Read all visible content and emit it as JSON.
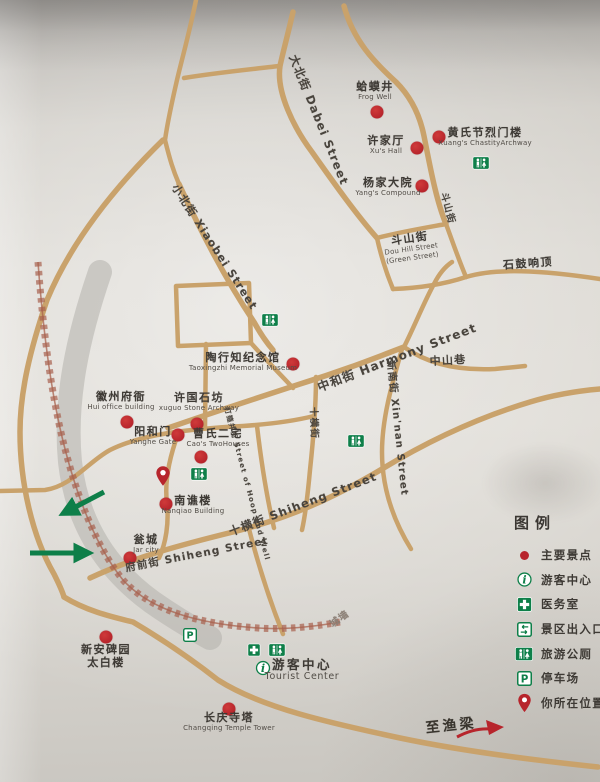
{
  "colors": {
    "road": "#c9a26b",
    "marker": "#b7252c",
    "green": "#0e7f49",
    "wall": "#a8614e"
  },
  "legend": {
    "title": "图例",
    "items": [
      {
        "icon": "dot",
        "label": "主要景点"
      },
      {
        "icon": "info",
        "label": "游客中心"
      },
      {
        "icon": "cross",
        "label": "医务室"
      },
      {
        "icon": "gate",
        "label": "景区出入口"
      },
      {
        "icon": "wc",
        "label": "旅游公厕"
      },
      {
        "icon": "parking",
        "label": "停车场"
      },
      {
        "icon": "pin",
        "label": "你所在位置"
      }
    ]
  },
  "map": {
    "pois": [
      {
        "id": "frog-well",
        "cn": "蛤蟆井",
        "en": "Frog Well",
        "x": 375,
        "y": 87,
        "dot": {
          "x": 377,
          "y": 112
        }
      },
      {
        "id": "xu-hall",
        "cn": "许家厅",
        "en": "Xu's Hall",
        "x": 386,
        "y": 141,
        "dot": {
          "x": 417,
          "y": 148
        }
      },
      {
        "id": "huang-chastity-archway",
        "cn": "黄氏节烈门楼",
        "en": "Xuang's ChastityArchway",
        "x": 485,
        "y": 133,
        "dot": {
          "x": 439,
          "y": 137
        }
      },
      {
        "id": "yang-compound",
        "cn": "杨家大院",
        "en": "Yang's Compound",
        "x": 388,
        "y": 183,
        "dot": {
          "x": 422,
          "y": 186
        }
      },
      {
        "id": "doushan-street-sign",
        "cn": "斗山街",
        "en": "Dou Hill Street",
        "en2": "(Green Street)",
        "x": 411,
        "y": 239,
        "rot": -8
      },
      {
        "id": "shigu-xiangding",
        "cn": "石鼓响顶",
        "x": 528,
        "y": 264,
        "rot": -4
      },
      {
        "id": "taoxingzhi-museum",
        "cn": "陶行知纪念馆",
        "en": "Taoxingzhi Memorial Museum",
        "x": 243,
        "y": 358,
        "dot": {
          "x": 293,
          "y": 364
        }
      },
      {
        "id": "huizhou-fuya",
        "cn": "徽州府衙",
        "en": "Hui office building",
        "x": 121,
        "y": 397,
        "dot": {
          "x": 127,
          "y": 422
        }
      },
      {
        "id": "xuguo-archway",
        "cn": "许国石坊",
        "en": "xuguo Stone Archway",
        "x": 199,
        "y": 398,
        "dot": {
          "x": 197,
          "y": 424
        }
      },
      {
        "id": "yanghe-gate",
        "cn": "阳和门",
        "en": "Yanghe Gate",
        "x": 153,
        "y": 432,
        "dot": {
          "x": 178,
          "y": 435
        }
      },
      {
        "id": "caos-two-houses",
        "cn": "曹氏二宅",
        "en": "Cao's TwoHouses",
        "x": 218,
        "y": 434,
        "dot": {
          "x": 201,
          "y": 457
        }
      },
      {
        "id": "nanqiao-building",
        "cn": "南谯楼",
        "en": "Nanqiao Building",
        "x": 193,
        "y": 501,
        "dot": {
          "x": 166,
          "y": 504
        }
      },
      {
        "id": "wengcheng",
        "cn": "瓮城",
        "en": "Jar city",
        "x": 146,
        "y": 540,
        "dot": {
          "x": 130,
          "y": 558
        }
      },
      {
        "id": "xinan-tablet-garden",
        "cn": "新安碑园",
        "cn2": "太白楼",
        "x": 106,
        "y": 650,
        "dot": {
          "x": 106,
          "y": 637
        }
      },
      {
        "id": "changqing-pagoda",
        "cn": "长庆寺塔",
        "en": "Changqing Temple Tower",
        "x": 229,
        "y": 718,
        "dot": {
          "x": 229,
          "y": 709
        }
      },
      {
        "id": "tourist-center",
        "cn": "游客中心",
        "en": "Tourist Center",
        "x": 302,
        "y": 665,
        "big": true
      }
    ],
    "streets": [
      {
        "id": "dabei-street",
        "text": "大北街 Dabei Street",
        "x": 319,
        "y": 120,
        "rot": 68,
        "size": 11.5
      },
      {
        "id": "xiaobei-street",
        "text": "小北街 Xiaobei Street",
        "x": 215,
        "y": 247,
        "rot": 57,
        "size": 11
      },
      {
        "id": "doushan-street",
        "text": "斗山街",
        "x": 449,
        "y": 208,
        "rot": 75,
        "size": 9.5
      },
      {
        "id": "harmony-street",
        "text": "中和街 Harmony Street",
        "x": 397,
        "y": 357,
        "rot": -21,
        "size": 12
      },
      {
        "id": "zhongshan-lane",
        "text": "中山巷",
        "x": 448,
        "y": 360,
        "rot": -3,
        "size": 11
      },
      {
        "id": "xinnan-street",
        "text": "新南街 Xin'nan Street",
        "x": 399,
        "y": 428,
        "rot": 84,
        "size": 10
      },
      {
        "id": "shiheng-street-north",
        "text": "十横街",
        "x": 315,
        "y": 423,
        "rot": 88,
        "size": 9.5
      },
      {
        "id": "dagujing-street",
        "text": "打箍井街 Street of Hoop and Well",
        "x": 247,
        "y": 484,
        "rot": 75,
        "size": 7
      },
      {
        "id": "shiheng-street-mid",
        "text": "十横街 Shiheng Street",
        "x": 303,
        "y": 504,
        "rot": -21,
        "size": 11.5
      },
      {
        "id": "fuqian-street",
        "text": "府前街 Shiheng Street",
        "x": 197,
        "y": 554,
        "rot": -11,
        "size": 10.5
      },
      {
        "id": "city-wall-label",
        "text": "城墙",
        "x": 339,
        "y": 618,
        "rot": -36,
        "size": 9.5,
        "color": "#8d8177"
      },
      {
        "id": "to-yuliang",
        "text": "至渔梁",
        "x": 451,
        "y": 725,
        "rot": -6,
        "size": 14
      }
    ],
    "icons": [
      {
        "type": "wc",
        "x": 481,
        "y": 163
      },
      {
        "type": "wc",
        "x": 270,
        "y": 320
      },
      {
        "type": "wc",
        "x": 199,
        "y": 474
      },
      {
        "type": "wc",
        "x": 356,
        "y": 441
      },
      {
        "type": "wc",
        "x": 277,
        "y": 650
      },
      {
        "type": "cross",
        "x": 254,
        "y": 650
      },
      {
        "type": "parking",
        "x": 190,
        "y": 635
      },
      {
        "type": "info",
        "x": 263,
        "y": 668
      },
      {
        "type": "pin",
        "x": 163,
        "y": 476
      }
    ]
  }
}
